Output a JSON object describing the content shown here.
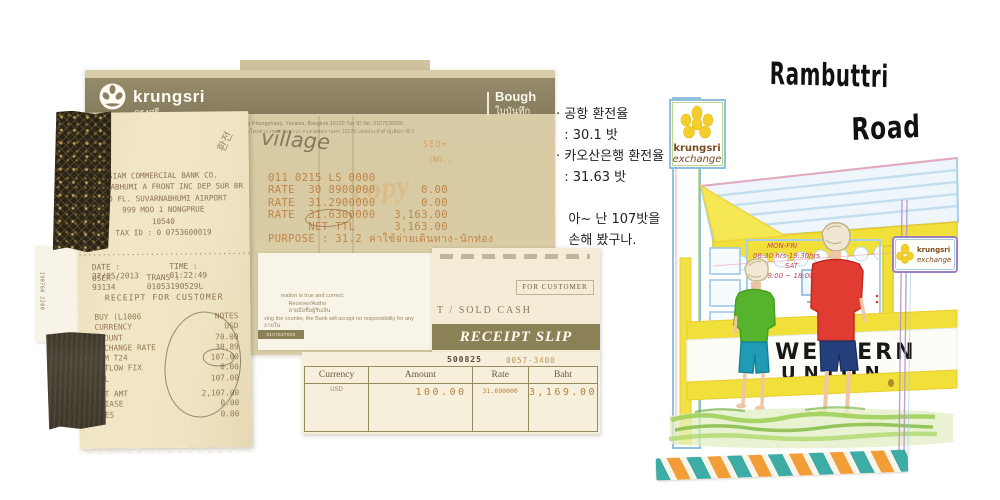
{
  "memo": {
    "brand": "krungsri",
    "brand_thai": "กรุงศรี",
    "tagline": "A member of MUFG, a global financial group",
    "doc_type_en": "Bough",
    "doc_type_th": "ใบบันทึก",
    "address_en": "Rd, Bang Phongphang, Yanawa, Bangkok 10120  Tax ID No. 0107536000",
    "address_th": "แขวงบางโพงพาง เขตยานนาวา กรุงเทพมหานคร 10120 เลขประจำตัวผู้เสียภาษี 0",
    "handwritten_note": "village",
    "seq_label": "SEQ=",
    "no_label": "(NO.,",
    "watermark": "copy",
    "lines": [
      {
        "l": "011 0215 LS 0000",
        "r": ""
      },
      {
        "l": "RATE  30 8900000",
        "r": "0.00"
      },
      {
        "l": "RATE  31.2900000",
        "r": "0.00"
      },
      {
        "l": "RATE  31.6300000",
        "r": "3,163.00"
      },
      {
        "l": "      NET TTL",
        "r": "3,163.00"
      },
      {
        "l": "PURPOSE : 31.2 ค่าใช้จ่ายเดินทาง-นักท่อง",
        "r": ""
      }
    ],
    "fine_print": [
      "           mation is true and correct.",
      "                Receiver/Autho",
      "                ลายมือชื่อผู้รับเงิน",
      "ving the counter, the Bank will accept no responsibility for any",
      "ภายใน"
    ],
    "chip_serial": "0107537000"
  },
  "thermal": {
    "pencil_note": "환전",
    "header": [
      "SIAM COMMERCIAL BANK CO.",
      "SUVARNABHUMI A FRONT INC DEP SUR BR",
      "2ND FL. SUVARNABHUMI AIRPORT",
      "999 MOO 1 NONGPRUE",
      "10540",
      "TAX ID : 0 0753600019"
    ],
    "divider": "·······························································",
    "date_l": "DATE : 27/05/2013",
    "date_r": "TIME : 01:22:49",
    "user_l": "USER : 93134",
    "user_r": "TRANS : 01053190529L",
    "title": "RECEIPT FOR CUSTOMER",
    "rows": [
      {
        "l": "BUY (L1006",
        "r": "NOTES"
      },
      {
        "l": "CURRENCY",
        "r": "USD"
      },
      {
        "l": "AMOUNT",
        "r": "70.00"
      },
      {
        "l": "EXCHANGE RATE",
        "r": "30.89"
      },
      {
        "l": "COM T24",
        "r": "107.00"
      },
      {
        "l": "W/TLOW FIX",
        "r": "0.00"
      },
      {
        "l": "TTL",
        "r": "107.00"
      },
      {
        "l": "NET AMT",
        "r": "2,107.00"
      },
      {
        "l": "ALIASE",
        "r": "0.00"
      },
      {
        "l": "FEES",
        "r": "0.00"
      }
    ],
    "side_text": "190760 2200"
  },
  "slip": {
    "for_customer": "FOR CUSTOMER",
    "sold_cash": "T / SOLD   CASH",
    "band_title": "RECEIPT SLIP",
    "serial_1": "500825",
    "serial_2": "0057-3400",
    "table": {
      "headers": [
        "Currency",
        "Amount",
        "Rate",
        "Baht"
      ],
      "row": [
        "USD",
        "100.00",
        "31.690000",
        "3,169.00"
      ]
    }
  },
  "notes": {
    "title_line1": "Rambuttri",
    "title_line2": "Road",
    "korean": [
      "· 공항 환전율",
      "  : 30.1 밧",
      "· 카오산은행 환전율",
      "  : 31.63 밧",
      "",
      "   아~ 난 107밧을",
      "   손해 봤구나."
    ]
  },
  "drawing": {
    "sign_line1": "krungsri",
    "sign_line2": "exchange",
    "small_sign_line1": "krungsri",
    "small_sign_line2": "exchange",
    "hours": [
      "MON-FRI",
      "08:30 hrs-19:30hrs",
      "SAT",
      "09:00 ~ 18:00"
    ],
    "storefront_line1": "WESTERN",
    "storefront_line2": "UNION"
  },
  "colors": {
    "brand_olive": "#8d8162",
    "paper_tan": "#d9cca6",
    "paper_cream": "#efe4c2",
    "slip_band": "#8b8157",
    "tape_teal": "#35a9a1",
    "tape_orange": "#f29a2e",
    "marker_yellow": "#f2e03a",
    "shirt_green": "#56b32e",
    "shirt_red": "#e03c31",
    "shorts_navy": "#24407c",
    "shorts_teal": "#1f9bb5",
    "receipt_ink": "#c08549"
  }
}
